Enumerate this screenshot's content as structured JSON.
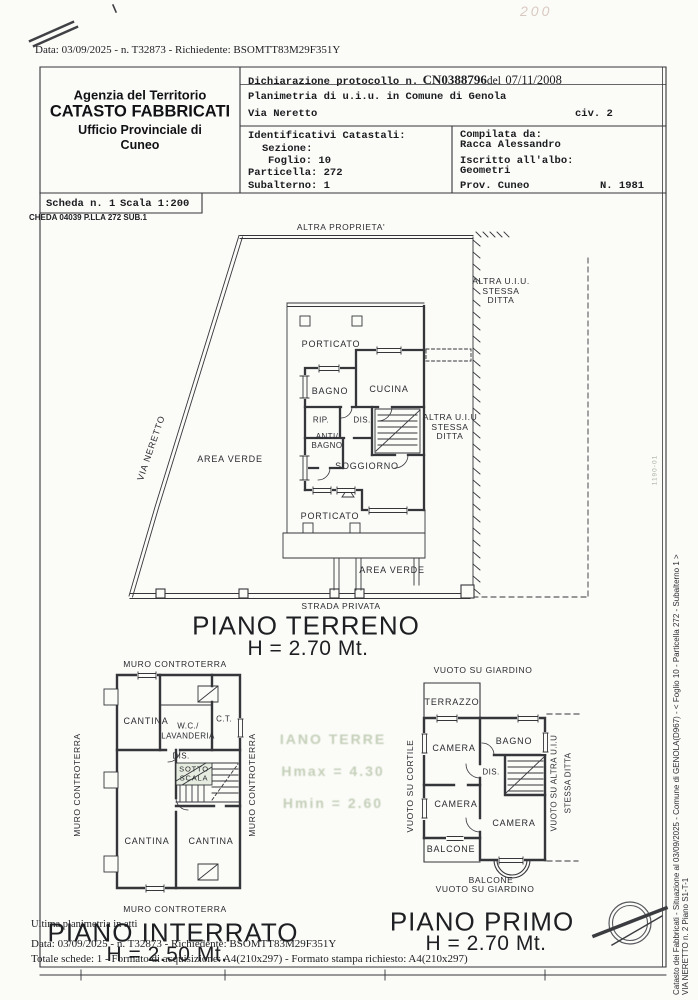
{
  "scan": {
    "top_header": "Data: 03/09/2025 - n. T32873 - Richiedente: BSOMTT83M29F351Y",
    "handwritten_mark": "200"
  },
  "colors": {
    "ink": "#33363a",
    "ghost_green": "#9fb28d",
    "paper": "#fbfbf8",
    "highlight": "#e7ece0"
  },
  "title_block": {
    "agency": {
      "line1": "Agenzia del Territorio",
      "line2": "CATASTO FABBRICATI",
      "line3": "Ufficio Provinciale di",
      "line4": "Cuneo"
    },
    "declaration": {
      "prefix": "Dichiarazione protocollo n.",
      "number": "CN0388796",
      "del": "del",
      "date": "07/11/2008"
    },
    "planimetria": "Planimetria di u.i.u. in Comune di Genola",
    "street": "Via Neretto",
    "civic": "civ. 2",
    "cadastral": {
      "title": "Identificativi Catastali:",
      "sezione": "Sezione:",
      "foglio": "Foglio: 10",
      "particella": "Particella: 272",
      "subalterno": "Subalterno: 1"
    },
    "compiler": {
      "label": "Compilata da:",
      "name": "Racca Alessandro",
      "albo_label": "Iscritto all'albo:",
      "albo": "Geometri",
      "prov": "Prov. Cuneo",
      "number": "N. 1981"
    },
    "scheda": "Scheda n. 1",
    "scala": "Scala 1:200",
    "sheet_code": "CHEDA 04039 P.LLA 272 SUB.1"
  },
  "ground_floor": {
    "context": {
      "altra_proprieta": "ALTRA PROPRIETA'",
      "via_neretto": "VIA NERETTO",
      "area_verde_left": "AREA VERDE",
      "area_verde_bottom": "AREA VERDE",
      "altra_uiu_ne": "ALTRA U.I.U.\nSTESSA\nDITTA",
      "altra_uiu_e": "ALTRA U.I.U\nSTESSA\nDITTA",
      "strada_privata": "STRADA PRIVATA"
    },
    "rooms": {
      "porticato_nord": "PORTICATO",
      "bagno": "BAGNO",
      "cucina": "CUCINA",
      "rip": "RIP.",
      "dis": "DIS.",
      "antibagno": "ANTI/\nBAGNO",
      "soggiorno": "SOGGIORNO",
      "porticato_sud": "PORTICATO"
    },
    "title": "PIANO TERRENO",
    "height": "H = 2.70 Mt."
  },
  "basement": {
    "context": {
      "muro_nord": "MURO CONTROTERRA",
      "muro_sud": "MURO CONTROTERRA",
      "muro_ovest": "MURO CONTROTERRA",
      "muro_est": "MURO CONTROTERRA"
    },
    "rooms": {
      "cantina_nord": "CANTINA",
      "wc_lavanderia": "W.C./\nLAVANDERIA",
      "ct": "C.T.",
      "dis": "DIS.",
      "sottoscala": "SOTTO\nSCALA",
      "cantina_ovest": "CANTINA",
      "cantina_est": "CANTINA"
    },
    "title": "PIANO INTERRATO",
    "height": "H = 2.50 Mt."
  },
  "first_floor": {
    "context": {
      "vuoto_giardino_nord": "VUOTO SU GIARDINO",
      "vuoto_giardino_sud": "VUOTO SU GIARDINO",
      "vuoto_cortile": "VUOTO SU CORTILE",
      "vuoto_altra_uiu": "VUOTO SU ALTRA U.I.U",
      "stessa_ditta": "STESSA DITTA"
    },
    "rooms": {
      "terrazzo": "TERRAZZO",
      "camera_nordovest": "CAMERA",
      "bagno": "BAGNO",
      "dis": "DIS.",
      "camera_ovest": "CAMERA",
      "camera_sudest": "CAMERA",
      "balcone_ovest": "BALCONE",
      "balcone_sud": "BALCONE"
    },
    "title": "PIANO PRIMO",
    "height": "H = 2.70 Mt."
  },
  "ghost_print": {
    "line1": "IANO TERRE",
    "line2": "Hmax = 4.30",
    "line3": "Hmin = 2.60",
    "code": "1190-01"
  },
  "footer": {
    "ultima": "Ultima planimetria in atti",
    "data_line": "Data: 03/09/2025 - n. T32873 - Richiedente: BSOMTT83M29F351Y",
    "totale_line": "Totale schede: 1 - Formato di acquisizione: A4(210x297) - Formato stampa richiesto: A4(210x297)"
  },
  "side_margin": {
    "line1": "Catasto dei Fabbricati - Situazione al 03/09/2025 - Comune di GENOLA(D967) - <  Foglio 10 - Particella  272 - Subalterno 1 >",
    "line2": "VIA NERETTO n. 2 Piano S1-T-1"
  }
}
